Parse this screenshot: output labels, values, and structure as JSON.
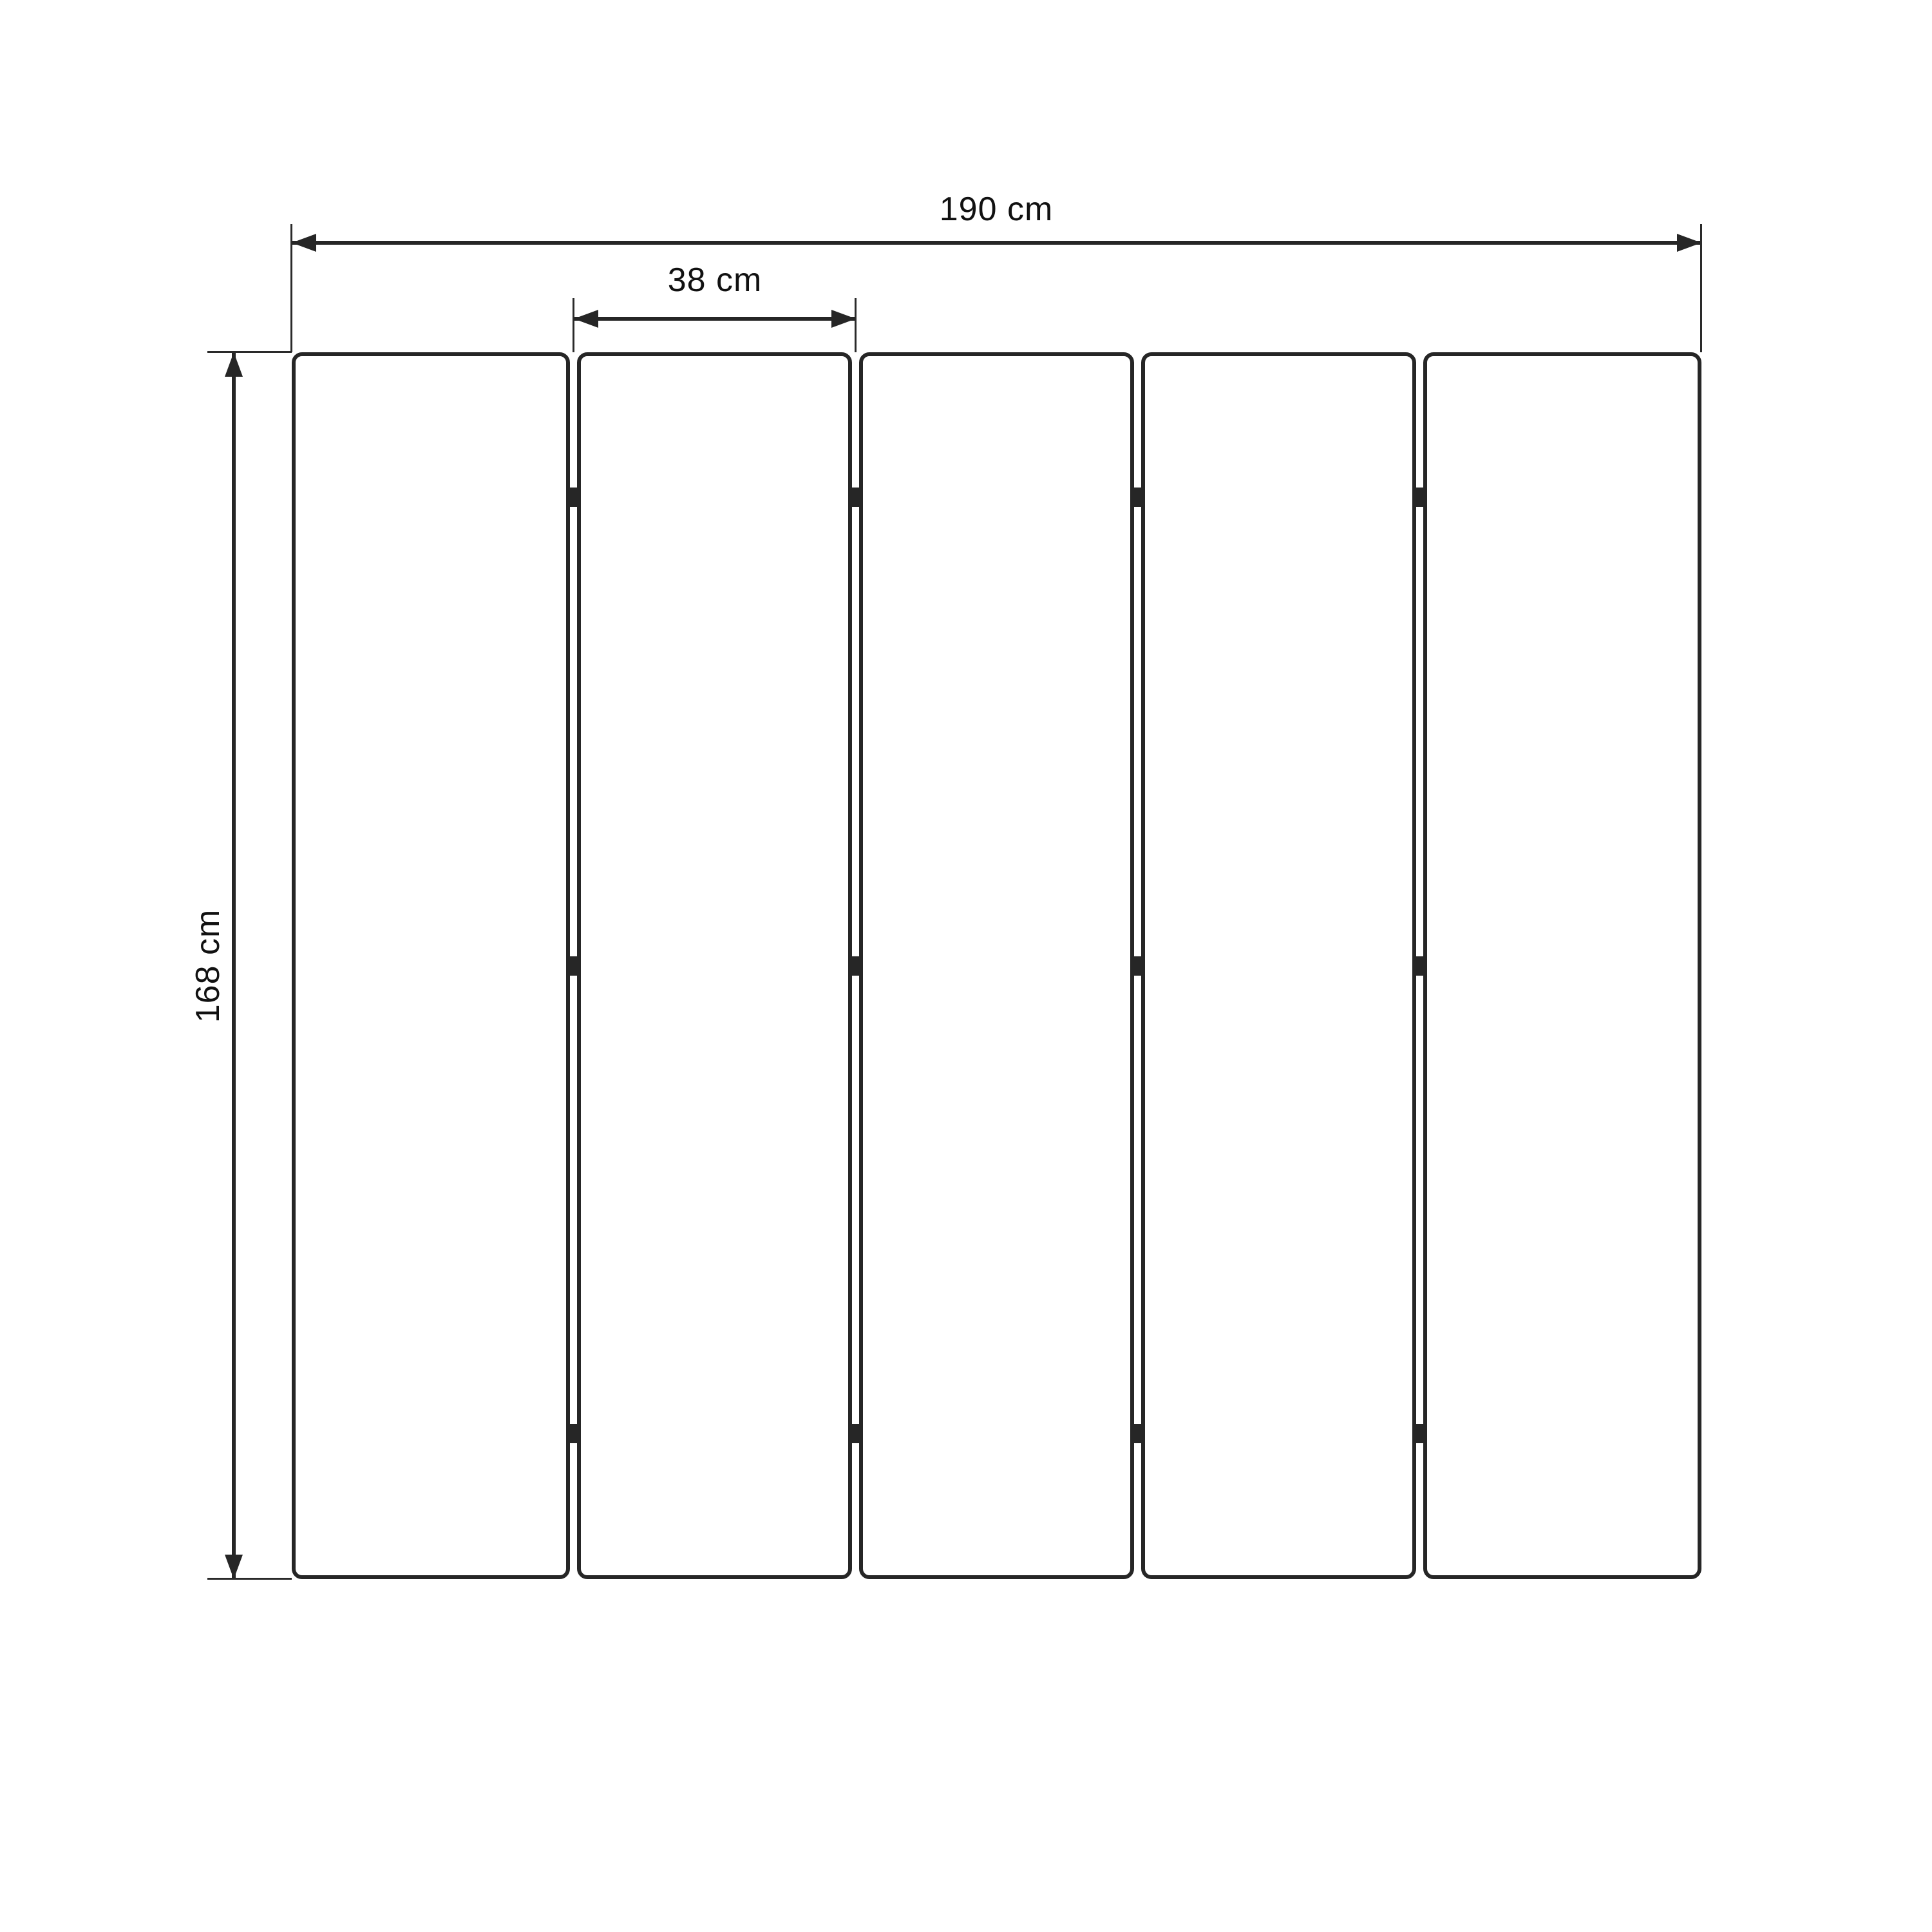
{
  "diagram": {
    "type": "technical-drawing",
    "total_width_label": "190 cm",
    "panel_width_label": "38 cm",
    "height_label": "168 cm",
    "panel_count": 5,
    "joint_count": 4,
    "hinges_per_joint": 3,
    "colors": {
      "line": "#262626",
      "text": "#111111",
      "background": "#ffffff"
    }
  }
}
